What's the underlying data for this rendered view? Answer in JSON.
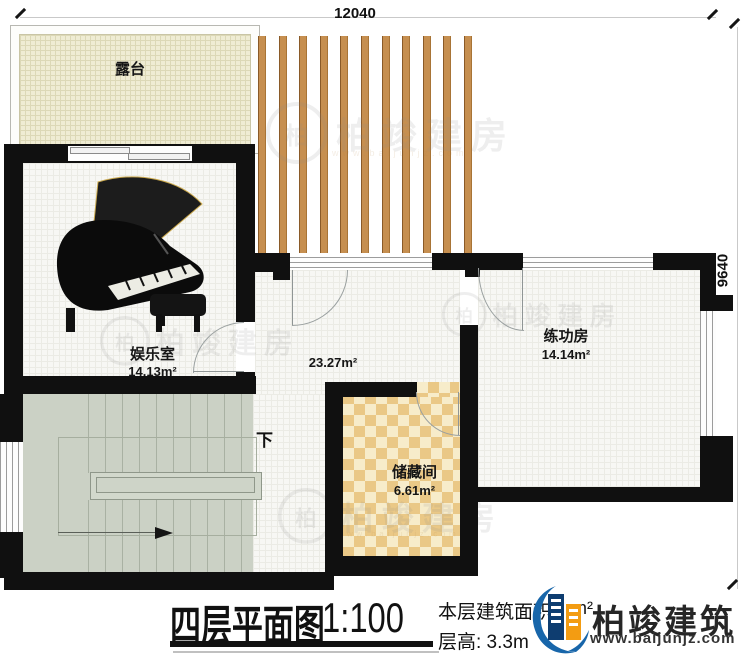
{
  "dimensions": {
    "top": "12040",
    "right": "9640"
  },
  "rooms": {
    "terrace": {
      "name": "露台"
    },
    "entertainment": {
      "name": "娱乐室",
      "area": "14.13m²"
    },
    "hall": {
      "area": "23.27m²"
    },
    "practice": {
      "name": "练功房",
      "area": "14.14m²"
    },
    "storage": {
      "name": "储藏间",
      "area": "6.61m²"
    },
    "stairs": {
      "down_label": "下"
    }
  },
  "title_block": {
    "title": "四层平面图",
    "scale": "1:100",
    "area_label": "本层建筑面积：",
    "area_value_visible": "7",
    "area_unit": "m²",
    "floor_height": "层高: 3.3m"
  },
  "brand": {
    "name": "柏竣建筑",
    "website": "www.baijunjz.com"
  },
  "watermark": {
    "text": "柏竣建房",
    "subtext": "www.baijunjz.com",
    "glyph": "柏"
  },
  "pergola": {
    "slat_count": 11
  },
  "colors": {
    "wall": "#101010",
    "slat": "#c68f50",
    "terrace_floor": "#efecd3",
    "stairs_floor": "#cbd1c5",
    "checker_dark": "#eac886",
    "checker_light": "#f7ecca",
    "logo_blue": "#1866aa",
    "logo_navy": "#0e3d70",
    "logo_orange": "#f39c12"
  }
}
